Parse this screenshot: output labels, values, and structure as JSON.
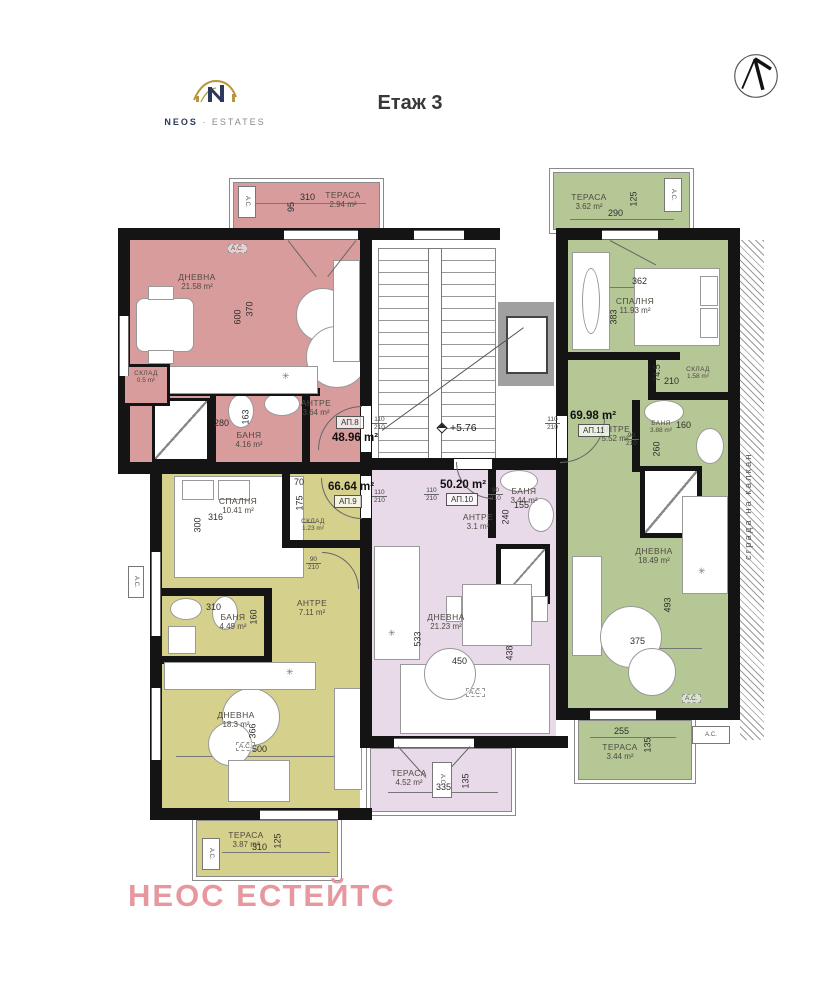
{
  "header": {
    "title": "Етаж 3",
    "logo_name": "NEOS",
    "logo_sep": "·",
    "logo_suffix": "ESTATES"
  },
  "watermark": "НЕОС ЕСТЕЙТС",
  "common": {
    "level": "+5.76",
    "side_note": "сграда на калкан",
    "ac": "A.C."
  },
  "icons": {
    "north_arrow": "north-arrow",
    "vent": "✳"
  },
  "ap8": {
    "badge": "АП.8",
    "total": "48.96 m²",
    "door_w": "110",
    "door_h": "210",
    "terrace": {
      "name": "ТЕРАСА",
      "area": "2.94 m²",
      "d1": "310",
      "d2": "95"
    },
    "living": {
      "name": "ДНЕВНА",
      "area": "21.58 m²",
      "d1": "600",
      "d2": "370"
    },
    "storage": {
      "name": "СКЛАД",
      "area": "0.5 m²"
    },
    "bath": {
      "name": "БАНЯ",
      "area": "4.16 m²",
      "d1": "280",
      "d2": "163"
    },
    "antre": {
      "name": "АНТРЕ",
      "area": "3.64 m²"
    }
  },
  "ap9": {
    "badge": "АП.9",
    "total": "66.64 m²",
    "door_w": "110",
    "door_h": "210",
    "door2_w": "90",
    "door2_h": "210",
    "bedroom": {
      "name": "СПАЛНЯ",
      "area": "10.41 m²",
      "d1": "316",
      "d2": "300"
    },
    "storage": {
      "name": "СКЛАД",
      "area": "1.23 m²",
      "d1": "70",
      "d2": "175"
    },
    "bath": {
      "name": "БАНЯ",
      "area": "4.49 m²",
      "d1": "310",
      "d2": "160"
    },
    "antre": {
      "name": "АНТРЕ",
      "area": "7.11 m²"
    },
    "living": {
      "name": "ДНЕВНА",
      "area": "18.3 m²",
      "d1": "366",
      "d2": "500"
    },
    "terrace": {
      "name": "ТЕРАСА",
      "area": "3.87 m²",
      "d1": "310",
      "d2": "125"
    }
  },
  "ap10": {
    "badge": "АП.10",
    "total": "50.20 m²",
    "door_w": "110",
    "door_h": "210",
    "door2_w": "90",
    "door2_h": "210",
    "antre": {
      "name": "АНТРЕ",
      "area": "3.1 m²"
    },
    "bath": {
      "name": "БАНЯ",
      "area": "3.44 m²",
      "d1": "155",
      "d2": "240"
    },
    "living": {
      "name": "ДНЕВНА",
      "area": "21.23 m²",
      "d1": "533",
      "d2": "450",
      "d3": "438"
    },
    "terrace": {
      "name": "ТЕРАСА",
      "area": "4.52 m²",
      "d1": "335",
      "d2": "135"
    }
  },
  "ap11": {
    "badge": "АП.11",
    "total": "69.98 m²",
    "door_w": "110",
    "door_h": "210",
    "door2_w": "90",
    "door2_h": "210",
    "terrace_top": {
      "name": "ТЕРАСА",
      "area": "3.62 m²",
      "d1": "290",
      "d2": "125"
    },
    "bedroom": {
      "name": "СПАЛНЯ",
      "area": "11.93 m²",
      "d1": "362",
      "d2": "383"
    },
    "storage": {
      "name": "СКЛАД",
      "area": "1.58 m²",
      "d1": "74.5",
      "d2": "210"
    },
    "antre": {
      "name": "АНТРЕ",
      "area": "5.52 m²"
    },
    "bath": {
      "name": "БАНЯ",
      "area": "3.88 m²",
      "d1": "160",
      "d2": "260"
    },
    "living": {
      "name": "ДНЕВНА",
      "area": "18.49 m²",
      "d1": "493",
      "d2": "375"
    },
    "terrace_bottom": {
      "name": "ТЕРАСА",
      "area": "3.44 m²",
      "d1": "255",
      "d2": "135"
    }
  }
}
